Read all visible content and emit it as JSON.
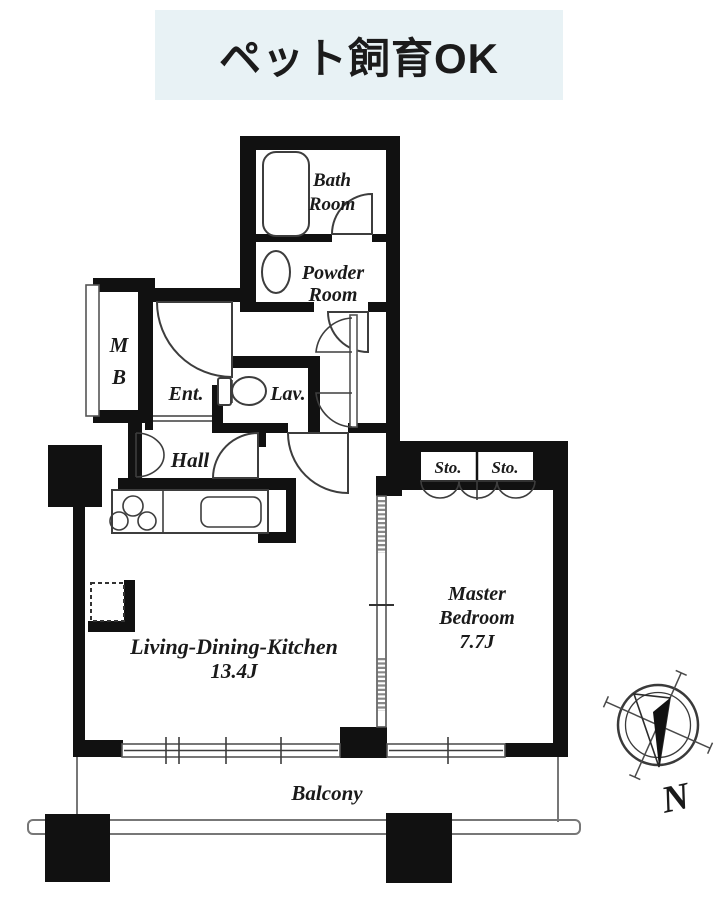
{
  "banner": {
    "text": "ペット飼育OK"
  },
  "plan": {
    "bath": {
      "l1": "Bath",
      "l2": "Room"
    },
    "powder": {
      "l1": "Powder",
      "l2": "Room"
    },
    "mb": {
      "l1": "M",
      "l2": "B"
    },
    "ent": "Ent.",
    "lav": "Lav.",
    "hall": "Hall",
    "sto1": "Sto.",
    "sto2": "Sto.",
    "master": {
      "l1": "Master",
      "l2": "Bedroom",
      "size": "7.7J"
    },
    "ldk": {
      "l1": "Living-Dining-Kitchen",
      "size": "13.4J"
    },
    "balcony": "Balcony",
    "compass_n": "N"
  },
  "colors": {
    "banner_bg": "#e8f2f5",
    "wall": "#111111",
    "fixture": "#3d3d3d",
    "outline": "#777777"
  }
}
